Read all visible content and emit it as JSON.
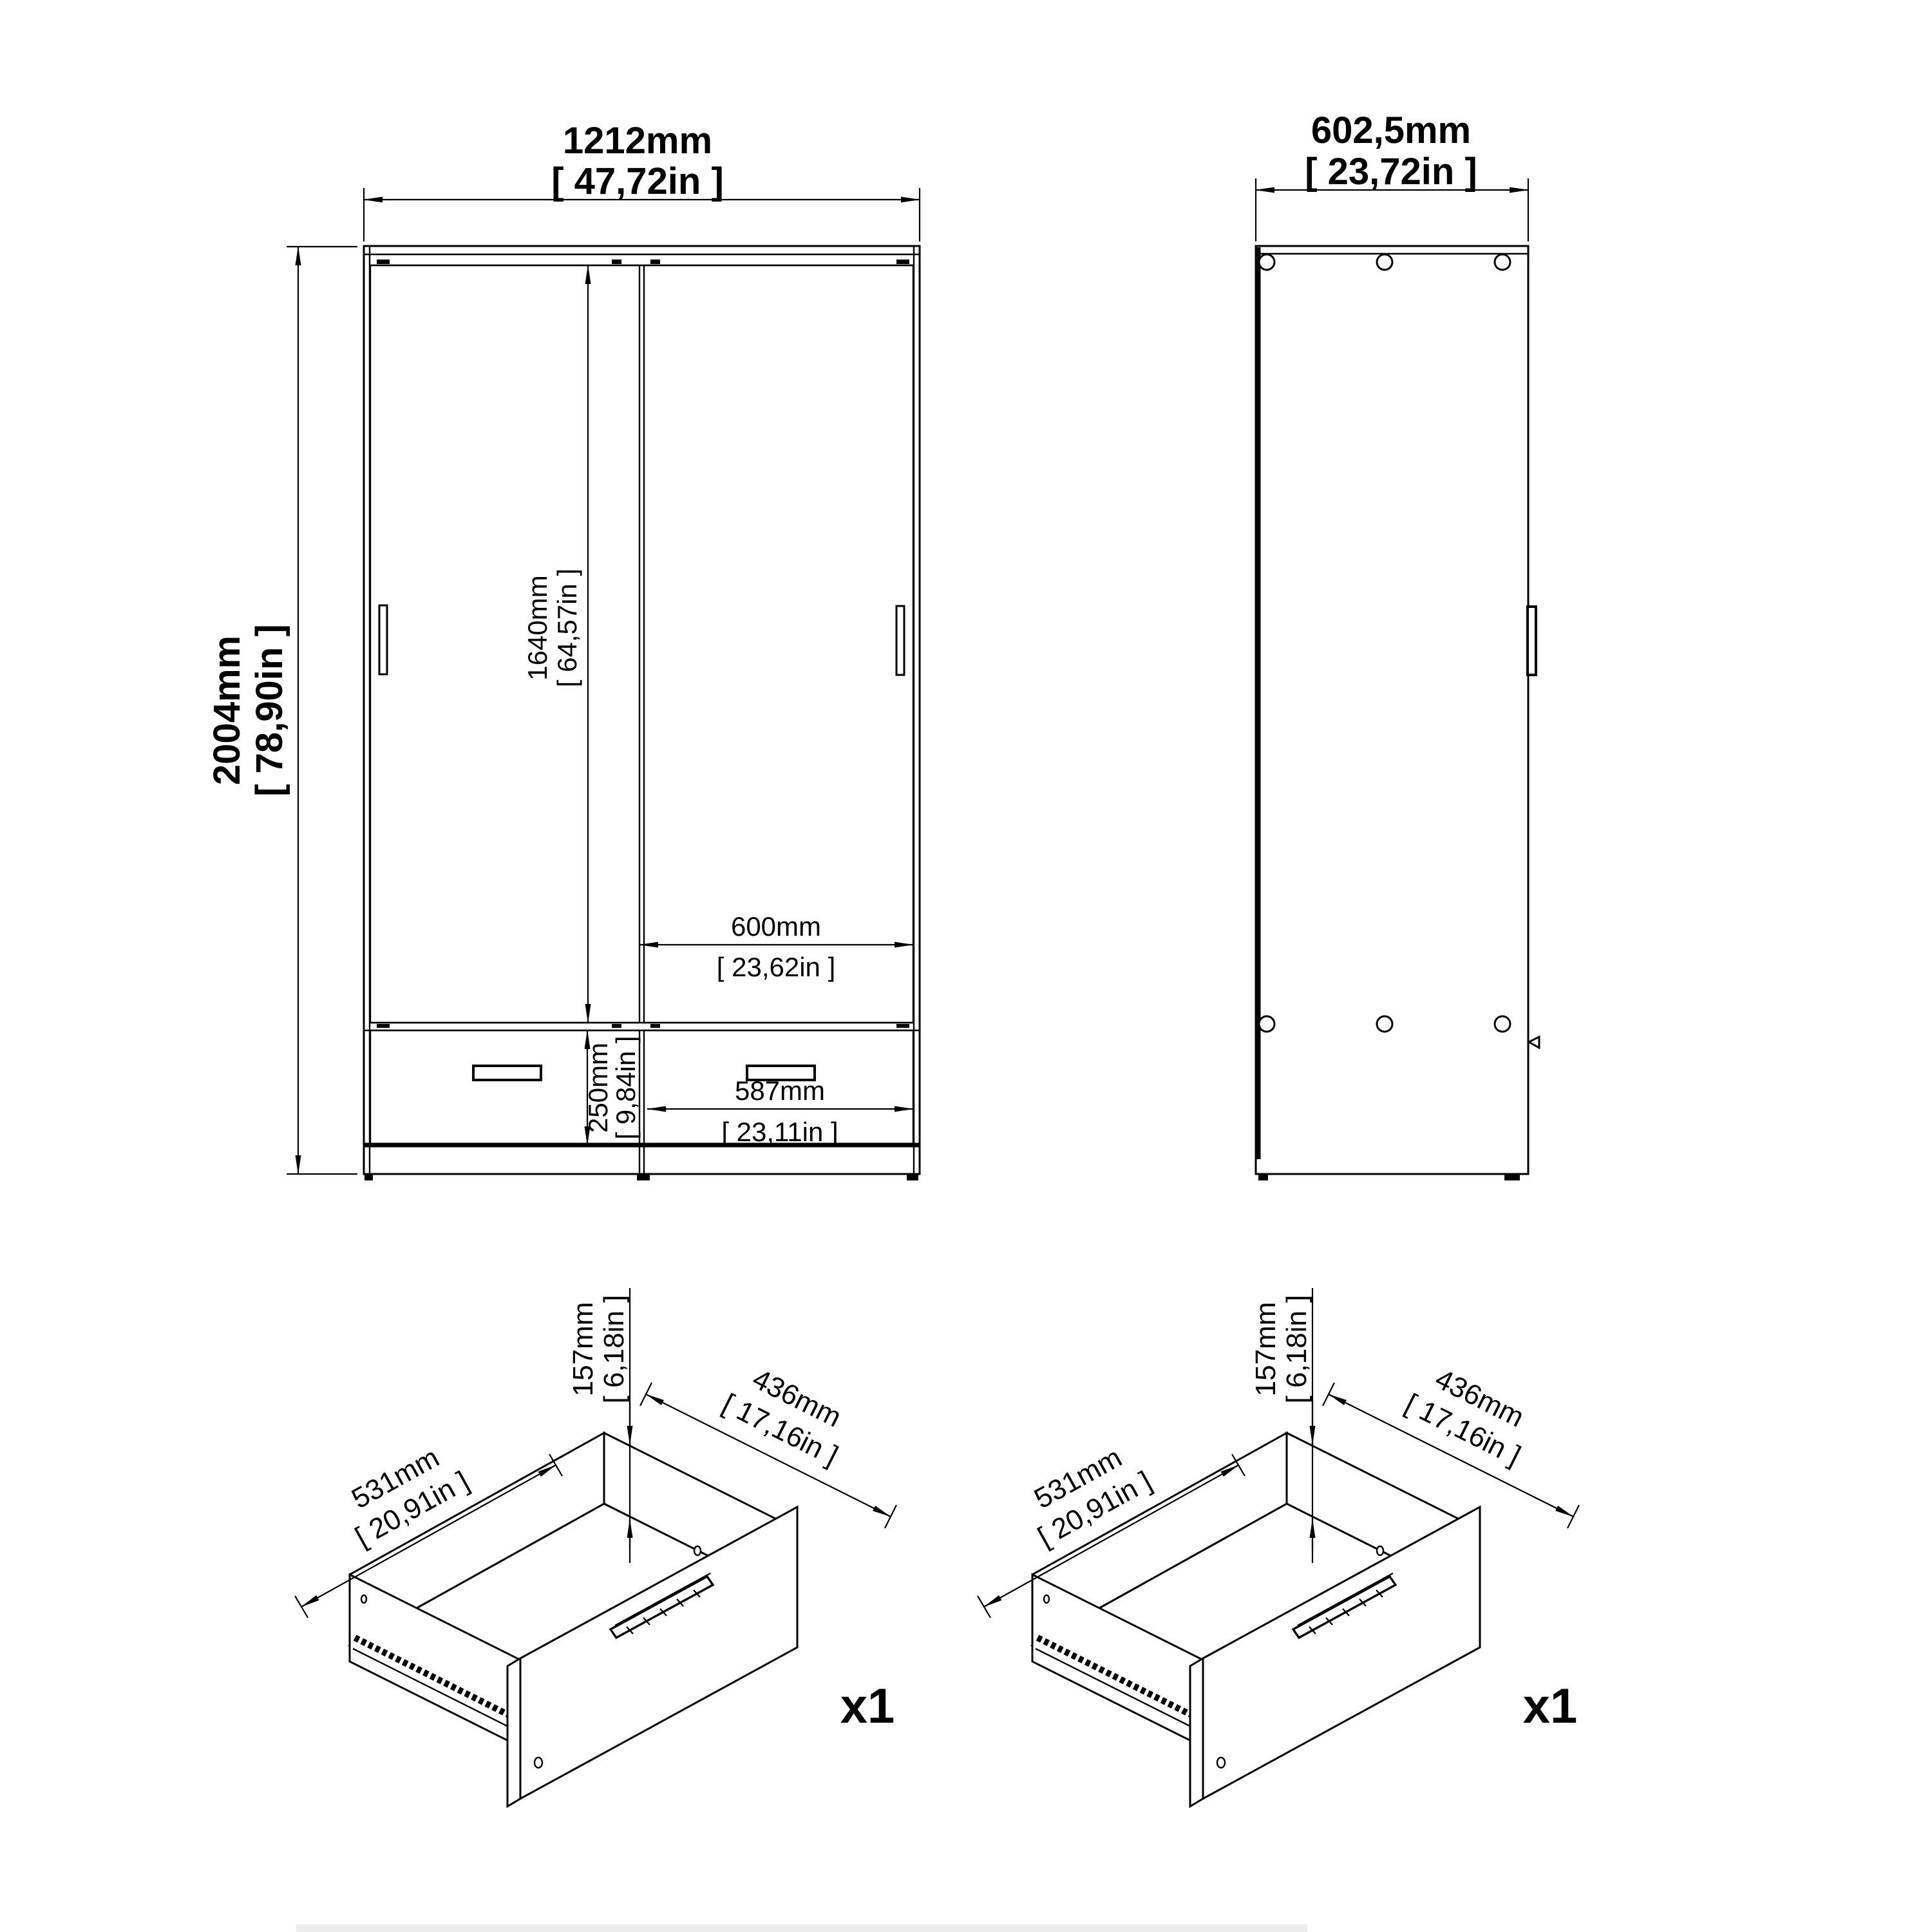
{
  "front_view": {
    "width": {
      "mm": "1212mm",
      "in": "[ 47,72in ]"
    },
    "height": {
      "mm": "2004mm",
      "in": "[ 78,90in ]"
    },
    "door_height": {
      "mm": "1640mm",
      "in": "[ 64,57in ]"
    },
    "right_door_width": {
      "mm": "600mm",
      "in": "[ 23,62in ]"
    },
    "drawer_front_height": {
      "mm": "250mm",
      "in": "[ 9,84in ]"
    },
    "drawer_front_width": {
      "mm": "587mm",
      "in": "[ 23,11in ]"
    }
  },
  "side_view": {
    "depth": {
      "mm": "602,5mm",
      "in": "[ 23,72in ]"
    }
  },
  "drawer_left": {
    "height": {
      "mm": "157mm",
      "in": "[ 6,18in ]"
    },
    "depth": {
      "mm": "531mm",
      "in": "[ 20,91in ]"
    },
    "width": {
      "mm": "436mm",
      "in": "[ 17,16in ]"
    },
    "quantity": "x1"
  },
  "drawer_right": {
    "height": {
      "mm": "157mm",
      "in": "[ 6,18in ]"
    },
    "depth": {
      "mm": "531mm",
      "in": "[ 20,91in ]"
    },
    "width": {
      "mm": "436mm",
      "in": "[ 17,16in ]"
    },
    "quantity": "x1"
  }
}
